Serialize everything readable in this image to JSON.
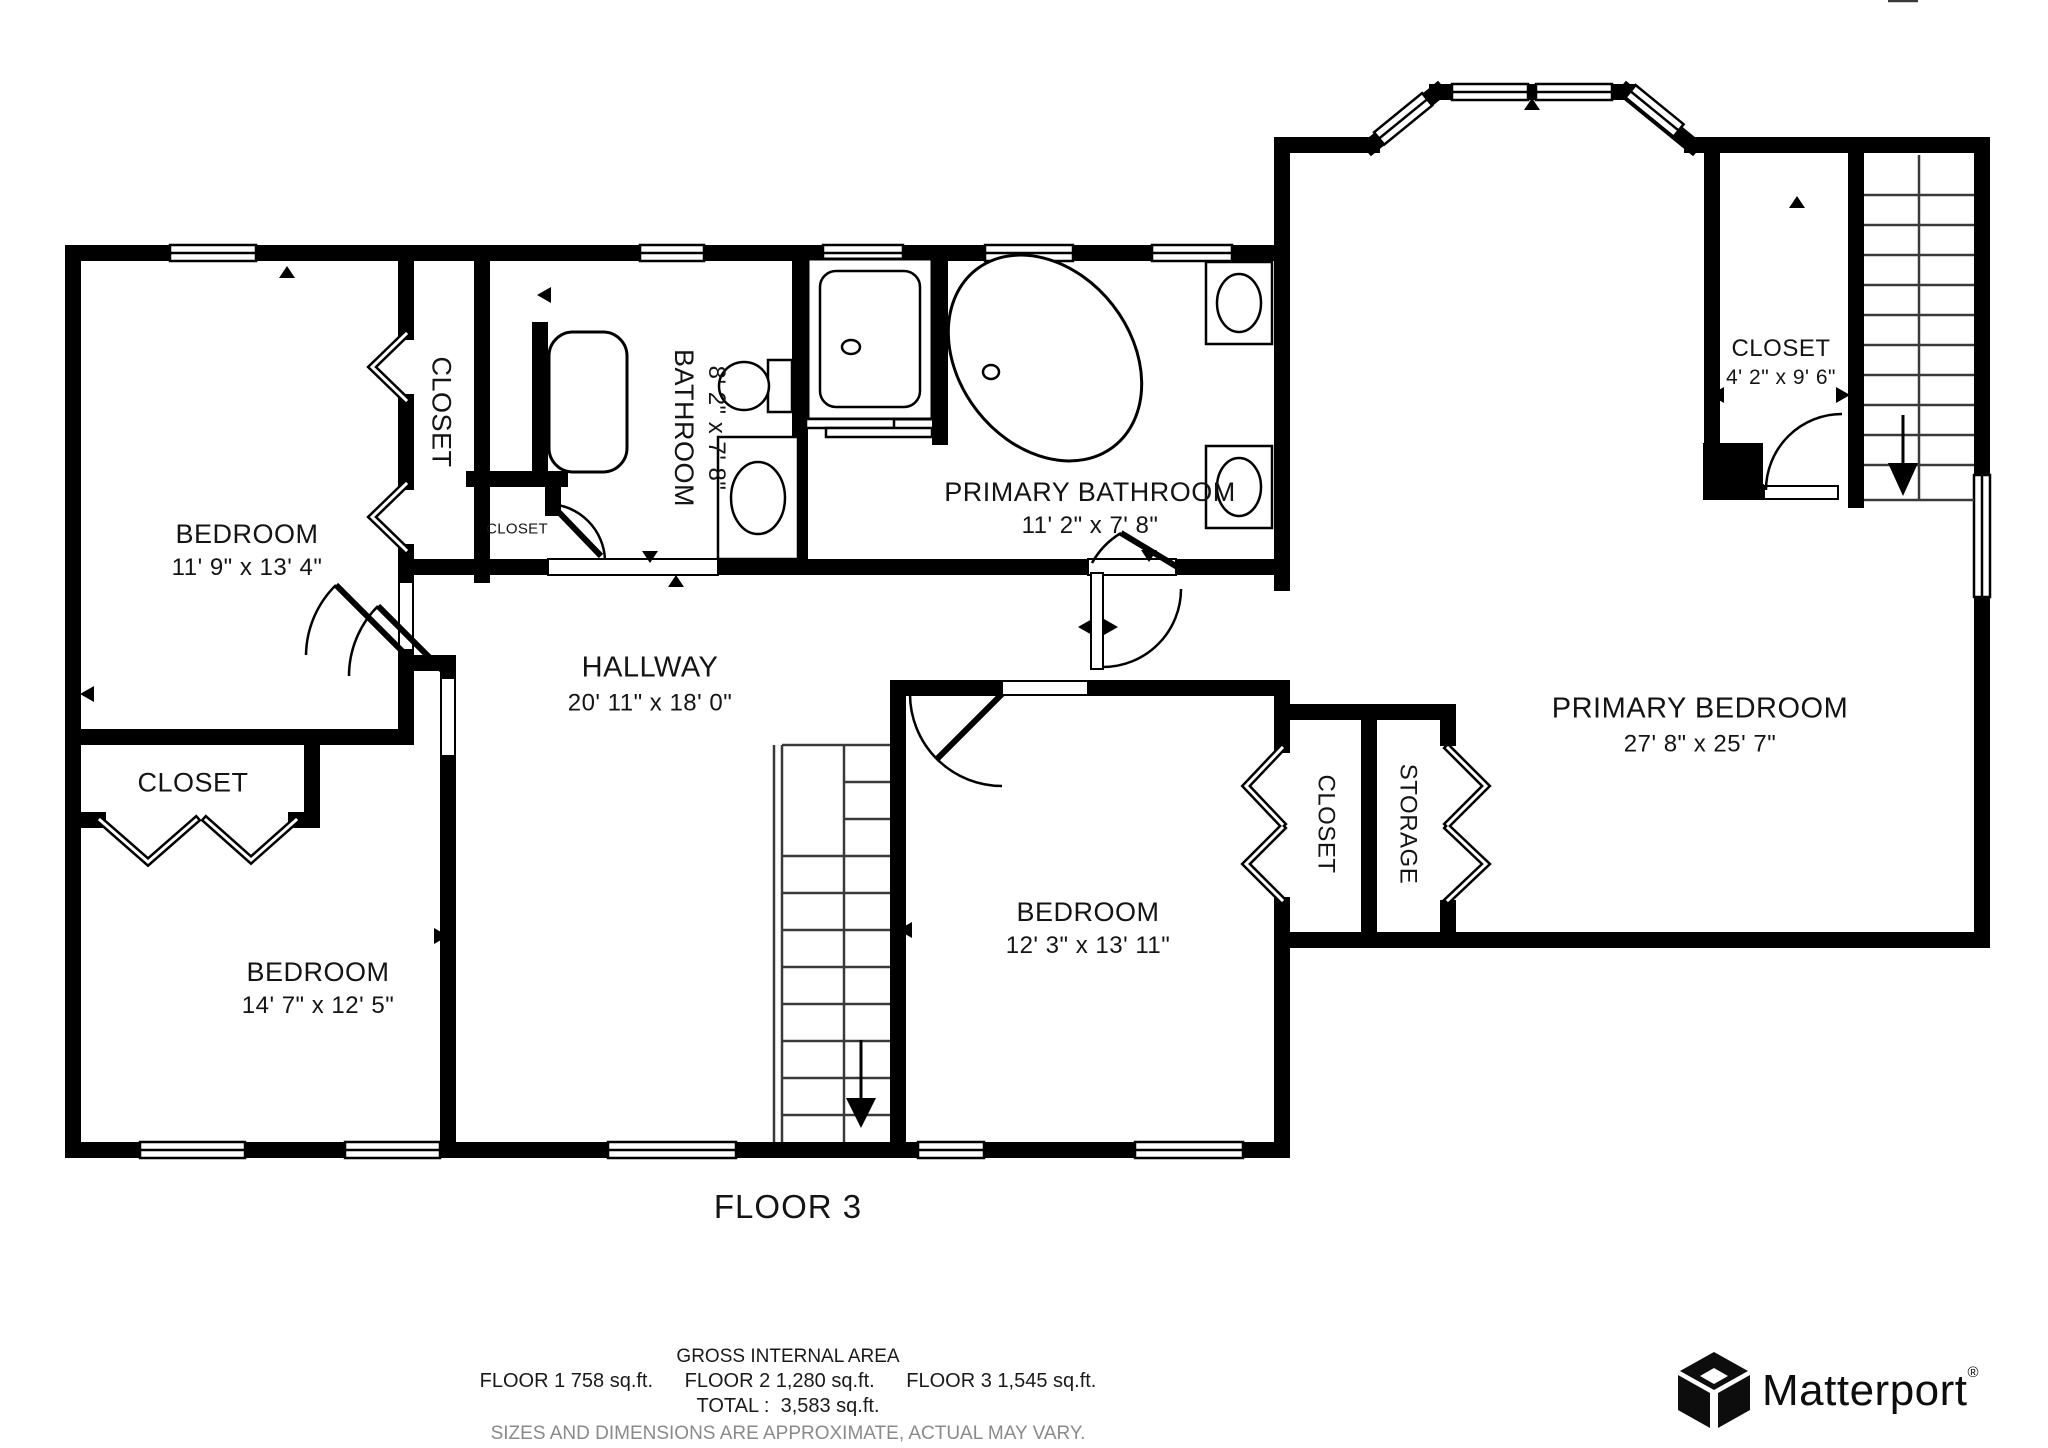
{
  "title": "FLOOR 3",
  "rooms": {
    "bedroom_tl": {
      "name": "BEDROOM",
      "dims": "11' 9\" x 13' 4\""
    },
    "closet_strip": {
      "name": "CLOSET"
    },
    "closet_small": {
      "name": "CLOSET"
    },
    "bathroom": {
      "name": "BATHROOM",
      "dims": "8' 2\" x 7' 8\""
    },
    "primary_bathroom": {
      "name": "PRIMARY BATHROOM",
      "dims": "11' 2\" x 7' 8\""
    },
    "closet_tr": {
      "name": "CLOSET",
      "dims": "4' 2\" x 9' 6\""
    },
    "hallway": {
      "name": "HALLWAY",
      "dims": "20' 11\" x 18' 0\""
    },
    "closet_ll": {
      "name": "CLOSET"
    },
    "bedroom_ll": {
      "name": "BEDROOM",
      "dims": "14' 7\" x 12' 5\""
    },
    "bedroom_center": {
      "name": "BEDROOM",
      "dims": "12' 3\" x 13' 11\""
    },
    "closet_pb": {
      "name": "CLOSET"
    },
    "storage": {
      "name": "STORAGE"
    },
    "primary_bedroom": {
      "name": "PRIMARY BEDROOM",
      "dims": "27' 8\" x 25' 7\""
    }
  },
  "footer": {
    "gross_area_label": "GROSS INTERNAL AREA",
    "floor1": "FLOOR 1 758 sq.ft.",
    "floor2": "FLOOR 2 1,280 sq.ft.",
    "floor3": "FLOOR 3 1,545 sq.ft.",
    "total": "TOTAL :  3,583 sq.ft.",
    "disclaimer": "SIZES AND DIMENSIONS ARE APPROXIMATE, ACTUAL MAY VARY."
  },
  "branding": {
    "name": "Matterport",
    "registered": "®"
  }
}
